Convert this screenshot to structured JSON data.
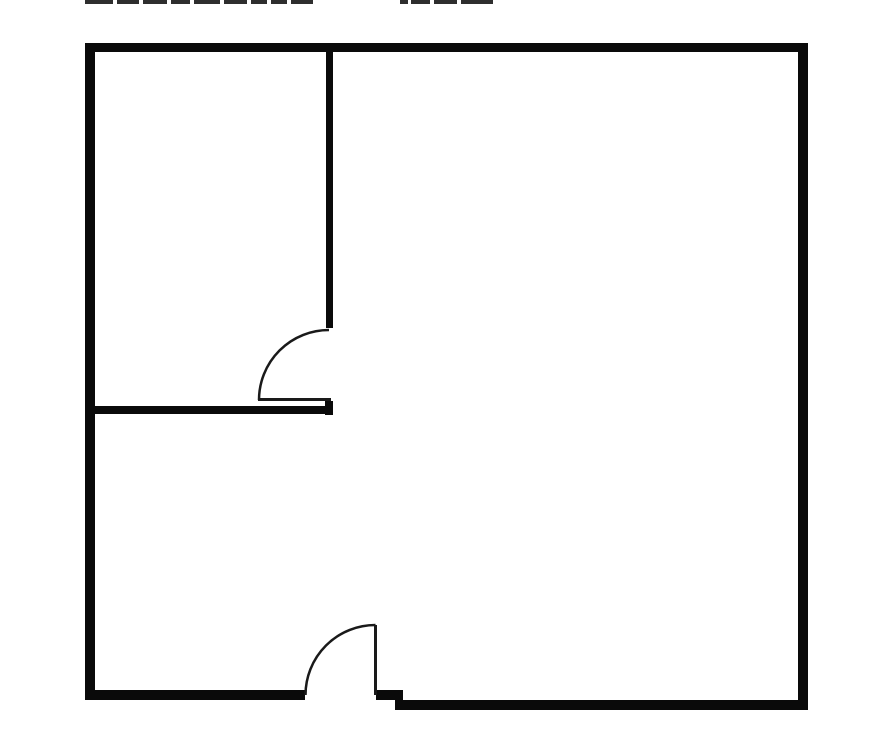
{
  "window": {
    "width": 895,
    "height": 753,
    "background": "#ffffff"
  },
  "top_edge_artifact": {
    "description": "bottom tips of a text line cut off by the top edge of the screenshot",
    "color": "#2e2e2e",
    "height": 4,
    "segments": [
      {
        "x": 85,
        "w": 28
      },
      {
        "x": 117,
        "w": 22
      },
      {
        "x": 143,
        "w": 24
      },
      {
        "x": 171,
        "w": 19
      },
      {
        "x": 194,
        "w": 26
      },
      {
        "x": 224,
        "w": 23
      },
      {
        "x": 251,
        "w": 16
      },
      {
        "x": 271,
        "w": 16
      },
      {
        "x": 291,
        "w": 22
      },
      {
        "x": 400,
        "w": 8
      },
      {
        "x": 411,
        "w": 19
      },
      {
        "x": 434,
        "w": 23
      },
      {
        "x": 461,
        "w": 32
      }
    ]
  },
  "floor_plan": {
    "wall_color": "#0a0a0a",
    "door_color": "#1a1a1a",
    "door_stroke_width": 2.5,
    "walls": [
      {
        "name": "outer-wall-top",
        "x": 85,
        "y": 43,
        "w": 723,
        "h": 9
      },
      {
        "name": "outer-wall-left",
        "x": 85,
        "y": 43,
        "w": 10,
        "h": 657
      },
      {
        "name": "outer-wall-right",
        "x": 798,
        "y": 43,
        "w": 10,
        "h": 667
      },
      {
        "name": "outer-wall-bottom-left",
        "x": 85,
        "y": 690,
        "w": 220,
        "h": 10
      },
      {
        "name": "outer-wall-bottom-mid",
        "x": 376,
        "y": 690,
        "w": 27,
        "h": 10
      },
      {
        "name": "outer-wall-bottom-right",
        "x": 395,
        "y": 700,
        "w": 413,
        "h": 10
      },
      {
        "name": "interior-wall-vertical",
        "x": 326,
        "y": 52,
        "w": 7,
        "h": 276
      },
      {
        "name": "interior-wall-horizontal",
        "x": 95,
        "y": 406,
        "w": 238,
        "h": 8
      },
      {
        "name": "interior-wall-door-jamb",
        "x": 325,
        "y": 401,
        "w": 8,
        "h": 14
      }
    ],
    "doors": [
      {
        "name": "interior-door",
        "leaf": {
          "x": 258,
          "y": 398,
          "w": 73,
          "h": 3
        },
        "arc": "M 329 330 A 70 70 0 0 0 259 400"
      },
      {
        "name": "entry-door",
        "leaf": {
          "x": 374,
          "y": 625,
          "w": 3,
          "h": 70
        },
        "arc": "M 375.5 625 A 70 70 0 0 0 305.5 695"
      }
    ]
  }
}
